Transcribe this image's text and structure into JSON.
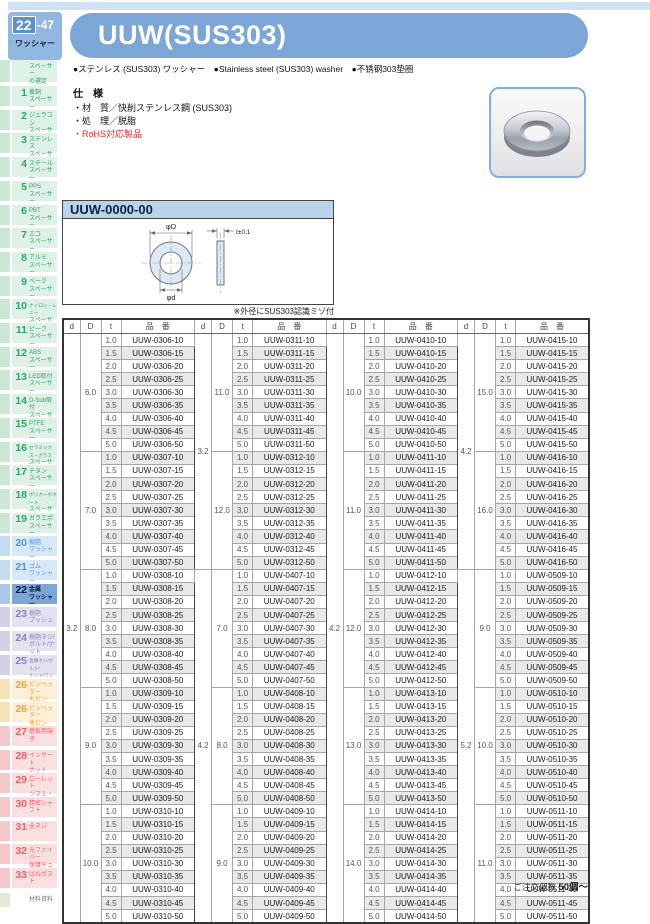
{
  "page_badge": {
    "num": "22",
    "sub": "-47",
    "category": "ワッシャー"
  },
  "header": {
    "title": "UUW(SUS303)",
    "bullets": "●ステンレス (SUS303) ワッシャー　●Stainless steel (SUS303) washer　●不锈钢303垫圈"
  },
  "spec": {
    "heading": "仕　様",
    "material": "・材　質／快削ステンレス鋼 (SUS303)",
    "treatment": "・処　理／脱脂",
    "rohs": "・RoHS対応製品"
  },
  "part_number_header": "UUW-0000-00",
  "drawing": {
    "label_outer": "φD",
    "label_inner": "φd",
    "label_thickness": "t±0.1",
    "note": "※外径にSUS303認識ミゾ付"
  },
  "order_note": {
    "prefix": "ご注文個数 ",
    "qty": "50個〜"
  },
  "colors": {
    "accent_blue": "#7ca6d8",
    "table_shade": "#e9e9e9",
    "rohs_red": "#e02a2a"
  },
  "sidebar": {
    "top": {
      "label": [
        "スペーサー",
        "の選定"
      ],
      "color": "green"
    },
    "items": [
      {
        "num": "1",
        "label": [
          "黄銅",
          "スペーサー"
        ],
        "color": "green"
      },
      {
        "num": "2",
        "label": [
          "ジュラコン",
          "スペーサー"
        ],
        "color": "green"
      },
      {
        "num": "3",
        "label": [
          "ステンレス",
          "スペーサー"
        ],
        "color": "green"
      },
      {
        "num": "4",
        "label": [
          "スチール",
          "スペーサー"
        ],
        "color": "green"
      },
      {
        "num": "5",
        "label": [
          "PPS",
          "スペーサー"
        ],
        "color": "green"
      },
      {
        "num": "6",
        "label": [
          "PBT",
          "スペーサー"
        ],
        "color": "green"
      },
      {
        "num": "7",
        "label": [
          "エコ",
          "スペーサー"
        ],
        "color": "green"
      },
      {
        "num": "8",
        "label": [
          "アルミ",
          "スペーサー"
        ],
        "color": "green"
      },
      {
        "num": "9",
        "label": [
          "ベーク",
          "スペーサー"
        ],
        "color": "green"
      },
      {
        "num": "10",
        "label": [
          "ナイロン・レニー",
          "スペーサー"
        ],
        "color": "green"
      },
      {
        "num": "11",
        "label": [
          "ピーク",
          "スペーサー"
        ],
        "color": "green"
      },
      {
        "num": "12",
        "label": [
          "ABS",
          "スペーサー"
        ],
        "color": "green"
      },
      {
        "num": "13",
        "label": [
          "LED取付",
          "スペーサー"
        ],
        "color": "green"
      },
      {
        "num": "14",
        "label": [
          "D-Sub取付",
          "スペーサー"
        ],
        "color": "green"
      },
      {
        "num": "15",
        "label": [
          "PTFE",
          "スペーサー"
        ],
        "color": "green"
      },
      {
        "num": "16",
        "label": [
          "セラミックス・ガラス",
          "スペーサー"
        ],
        "color": "green"
      },
      {
        "num": "17",
        "label": [
          "チタン",
          "スペーサー"
        ],
        "color": "green"
      },
      {
        "num": "18",
        "label": [
          "ポリカーボネート",
          "スペーサー"
        ],
        "color": "green"
      },
      {
        "num": "19",
        "label": [
          "ガラエポ",
          "スペーサー"
        ],
        "color": "green"
      },
      {
        "num": "20",
        "label": [
          "樹脂",
          "ワッシャー"
        ],
        "color": "blue"
      },
      {
        "num": "21",
        "label": [
          "ゴム",
          "ワッシャー"
        ],
        "color": "blue"
      },
      {
        "num": "22",
        "label": [
          "金属",
          "ワッシャー"
        ],
        "color": "blue",
        "active": true
      },
      {
        "num": "23",
        "label": [
          "樹脂",
          "ブッシュ"
        ],
        "color": "purple"
      },
      {
        "num": "24",
        "label": [
          "樹脂ネジ/",
          "ボルト/ナット"
        ],
        "color": "purple"
      },
      {
        "num": "25",
        "label": [
          "金属ネジ/ボルト/",
          "ナット/ワッシャー"
        ],
        "color": "purple"
      },
      {
        "num": "26",
        "label": [
          "ピンヘッダー",
          "丸ピン"
        ],
        "color": "orange"
      },
      {
        "num": "26",
        "label": [
          "ピンヘッダー",
          "角ピン"
        ],
        "color": "orange"
      },
      {
        "num": "27",
        "label": [
          "基板用端子"
        ],
        "color": "red"
      },
      {
        "num": "28",
        "label": [
          "インサート",
          "ナット"
        ],
        "color": "red"
      },
      {
        "num": "29",
        "label": [
          "ローレット",
          "ツマミ・ナット"
        ],
        "color": "red"
      },
      {
        "num": "30",
        "label": [
          "精密シャフト"
        ],
        "color": "red"
      },
      {
        "num": "31",
        "label": [
          "全ネジ"
        ],
        "color": "red"
      },
      {
        "num": "32",
        "label": [
          "光ファイバー",
          "保護チューブ"
        ],
        "color": "red"
      },
      {
        "num": "33",
        "label": [
          "ばねポスト"
        ],
        "color": "red"
      }
    ],
    "bottom": {
      "label": [
        "材料資料"
      ],
      "color": "beige"
    }
  },
  "table": {
    "col_headers": [
      "d",
      "D",
      "t",
      "品　番"
    ],
    "t_values": [
      "1.0",
      "1.5",
      "2.0",
      "2.5",
      "3.0",
      "3.5",
      "4.0",
      "4.5",
      "5.0"
    ],
    "groups": [
      {
        "sections": [
          {
            "d": "3.2",
            "blocks": [
              {
                "D": "6.0",
                "parts": [
                  "UUW-0306-10",
                  "UUW-0306-15",
                  "UUW-0306-20",
                  "UUW-0306-25",
                  "UUW-0306-30",
                  "UUW-0306-35",
                  "UUW-0306-40",
                  "UUW-0306-45",
                  "UUW-0306-50"
                ]
              },
              {
                "D": "7.0",
                "parts": [
                  "UUW-0307-10",
                  "UUW-0307-15",
                  "UUW-0307-20",
                  "UUW-0307-25",
                  "UUW-0307-30",
                  "UUW-0307-35",
                  "UUW-0307-40",
                  "UUW-0307-45",
                  "UUW-0307-50"
                ]
              },
              {
                "D": "8.0",
                "parts": [
                  "UUW-0308-10",
                  "UUW-0308-15",
                  "UUW-0308-20",
                  "UUW-0308-25",
                  "UUW-0308-30",
                  "UUW-0308-35",
                  "UUW-0308-40",
                  "UUW-0308-45",
                  "UUW-0308-50"
                ]
              },
              {
                "D": "9.0",
                "parts": [
                  "UUW-0309-10",
                  "UUW-0309-15",
                  "UUW-0309-20",
                  "UUW-0309-25",
                  "UUW-0309-30",
                  "UUW-0309-35",
                  "UUW-0309-40",
                  "UUW-0309-45",
                  "UUW-0309-50"
                ]
              },
              {
                "D": "10.0",
                "parts": [
                  "UUW-0310-10",
                  "UUW-0310-15",
                  "UUW-0310-20",
                  "UUW-0310-25",
                  "UUW-0310-30",
                  "UUW-0310-35",
                  "UUW-0310-40",
                  "UUW-0310-45",
                  "UUW-0310-50"
                ]
              }
            ]
          }
        ]
      },
      {
        "sections": [
          {
            "d": "3.2",
            "blocks": [
              {
                "D": "11.0",
                "parts": [
                  "UUW-0311-10",
                  "UUW-0311-15",
                  "UUW-0311-20",
                  "UUW-0311-25",
                  "UUW-0311-30",
                  "UUW-0311-35",
                  "UUW-0311-40",
                  "UUW-0311-45",
                  "UUW-0311-50"
                ]
              },
              {
                "D": "12.0",
                "parts": [
                  "UUW-0312-10",
                  "UUW-0312-15",
                  "UUW-0312-20",
                  "UUW-0312-25",
                  "UUW-0312-30",
                  "UUW-0312-35",
                  "UUW-0312-40",
                  "UUW-0312-45",
                  "UUW-0312-50"
                ]
              }
            ]
          },
          {
            "d": "4.2",
            "blocks": [
              {
                "D": "7.0",
                "parts": [
                  "UUW-0407-10",
                  "UUW-0407-15",
                  "UUW-0407-20",
                  "UUW-0407-25",
                  "UUW-0407-30",
                  "UUW-0407-35",
                  "UUW-0407-40",
                  "UUW-0407-45",
                  "UUW-0407-50"
                ]
              },
              {
                "D": "8.0",
                "parts": [
                  "UUW-0408-10",
                  "UUW-0408-15",
                  "UUW-0408-20",
                  "UUW-0408-25",
                  "UUW-0408-30",
                  "UUW-0408-35",
                  "UUW-0408-40",
                  "UUW-0408-45",
                  "UUW-0408-50"
                ]
              },
              {
                "D": "9.0",
                "parts": [
                  "UUW-0409-10",
                  "UUW-0409-15",
                  "UUW-0409-20",
                  "UUW-0409-25",
                  "UUW-0409-30",
                  "UUW-0409-35",
                  "UUW-0409-40",
                  "UUW-0409-45",
                  "UUW-0409-50"
                ]
              }
            ]
          }
        ]
      },
      {
        "sections": [
          {
            "d": "4.2",
            "blocks": [
              {
                "D": "10.0",
                "parts": [
                  "UUW-0410-10",
                  "UUW-0410-15",
                  "UUW-0410-20",
                  "UUW-0410-25",
                  "UUW-0410-30",
                  "UUW-0410-35",
                  "UUW-0410-40",
                  "UUW-0410-45",
                  "UUW-0410-50"
                ]
              },
              {
                "D": "11.0",
                "parts": [
                  "UUW-0411-10",
                  "UUW-0411-15",
                  "UUW-0411-20",
                  "UUW-0411-25",
                  "UUW-0411-30",
                  "UUW-0411-35",
                  "UUW-0411-40",
                  "UUW-0411-45",
                  "UUW-0411-50"
                ]
              },
              {
                "D": "12.0",
                "parts": [
                  "UUW-0412-10",
                  "UUW-0412-15",
                  "UUW-0412-20",
                  "UUW-0412-25",
                  "UUW-0412-30",
                  "UUW-0412-35",
                  "UUW-0412-40",
                  "UUW-0412-45",
                  "UUW-0412-50"
                ]
              },
              {
                "D": "13.0",
                "parts": [
                  "UUW-0413-10",
                  "UUW-0413-15",
                  "UUW-0413-20",
                  "UUW-0413-25",
                  "UUW-0413-30",
                  "UUW-0413-35",
                  "UUW-0413-40",
                  "UUW-0413-45",
                  "UUW-0413-50"
                ]
              },
              {
                "D": "14.0",
                "parts": [
                  "UUW-0414-10",
                  "UUW-0414-15",
                  "UUW-0414-20",
                  "UUW-0414-25",
                  "UUW-0414-30",
                  "UUW-0414-35",
                  "UUW-0414-40",
                  "UUW-0414-45",
                  "UUW-0414-50"
                ]
              }
            ]
          }
        ]
      },
      {
        "sections": [
          {
            "d": "4.2",
            "blocks": [
              {
                "D": "15.0",
                "parts": [
                  "UUW-0415-10",
                  "UUW-0415-15",
                  "UUW-0415-20",
                  "UUW-0415-25",
                  "UUW-0415-30",
                  "UUW-0415-35",
                  "UUW-0415-40",
                  "UUW-0415-45",
                  "UUW-0415-50"
                ]
              },
              {
                "D": "16.0",
                "parts": [
                  "UUW-0416-10",
                  "UUW-0416-15",
                  "UUW-0416-20",
                  "UUW-0416-25",
                  "UUW-0416-30",
                  "UUW-0416-35",
                  "UUW-0416-40",
                  "UUW-0416-45",
                  "UUW-0416-50"
                ]
              }
            ]
          },
          {
            "d": "5.2",
            "blocks": [
              {
                "D": "9.0",
                "parts": [
                  "UUW-0509-10",
                  "UUW-0509-15",
                  "UUW-0509-20",
                  "UUW-0509-25",
                  "UUW-0509-30",
                  "UUW-0509-35",
                  "UUW-0509-40",
                  "UUW-0509-45",
                  "UUW-0509-50"
                ]
              },
              {
                "D": "10.0",
                "parts": [
                  "UUW-0510-10",
                  "UUW-0510-15",
                  "UUW-0510-20",
                  "UUW-0510-25",
                  "UUW-0510-30",
                  "UUW-0510-35",
                  "UUW-0510-40",
                  "UUW-0510-45",
                  "UUW-0510-50"
                ]
              },
              {
                "D": "11.0",
                "parts": [
                  "UUW-0511-10",
                  "UUW-0511-15",
                  "UUW-0511-20",
                  "UUW-0511-25",
                  "UUW-0511-30",
                  "UUW-0511-35",
                  "UUW-0511-40",
                  "UUW-0511-45",
                  "UUW-0511-50"
                ]
              }
            ]
          }
        ]
      }
    ]
  }
}
